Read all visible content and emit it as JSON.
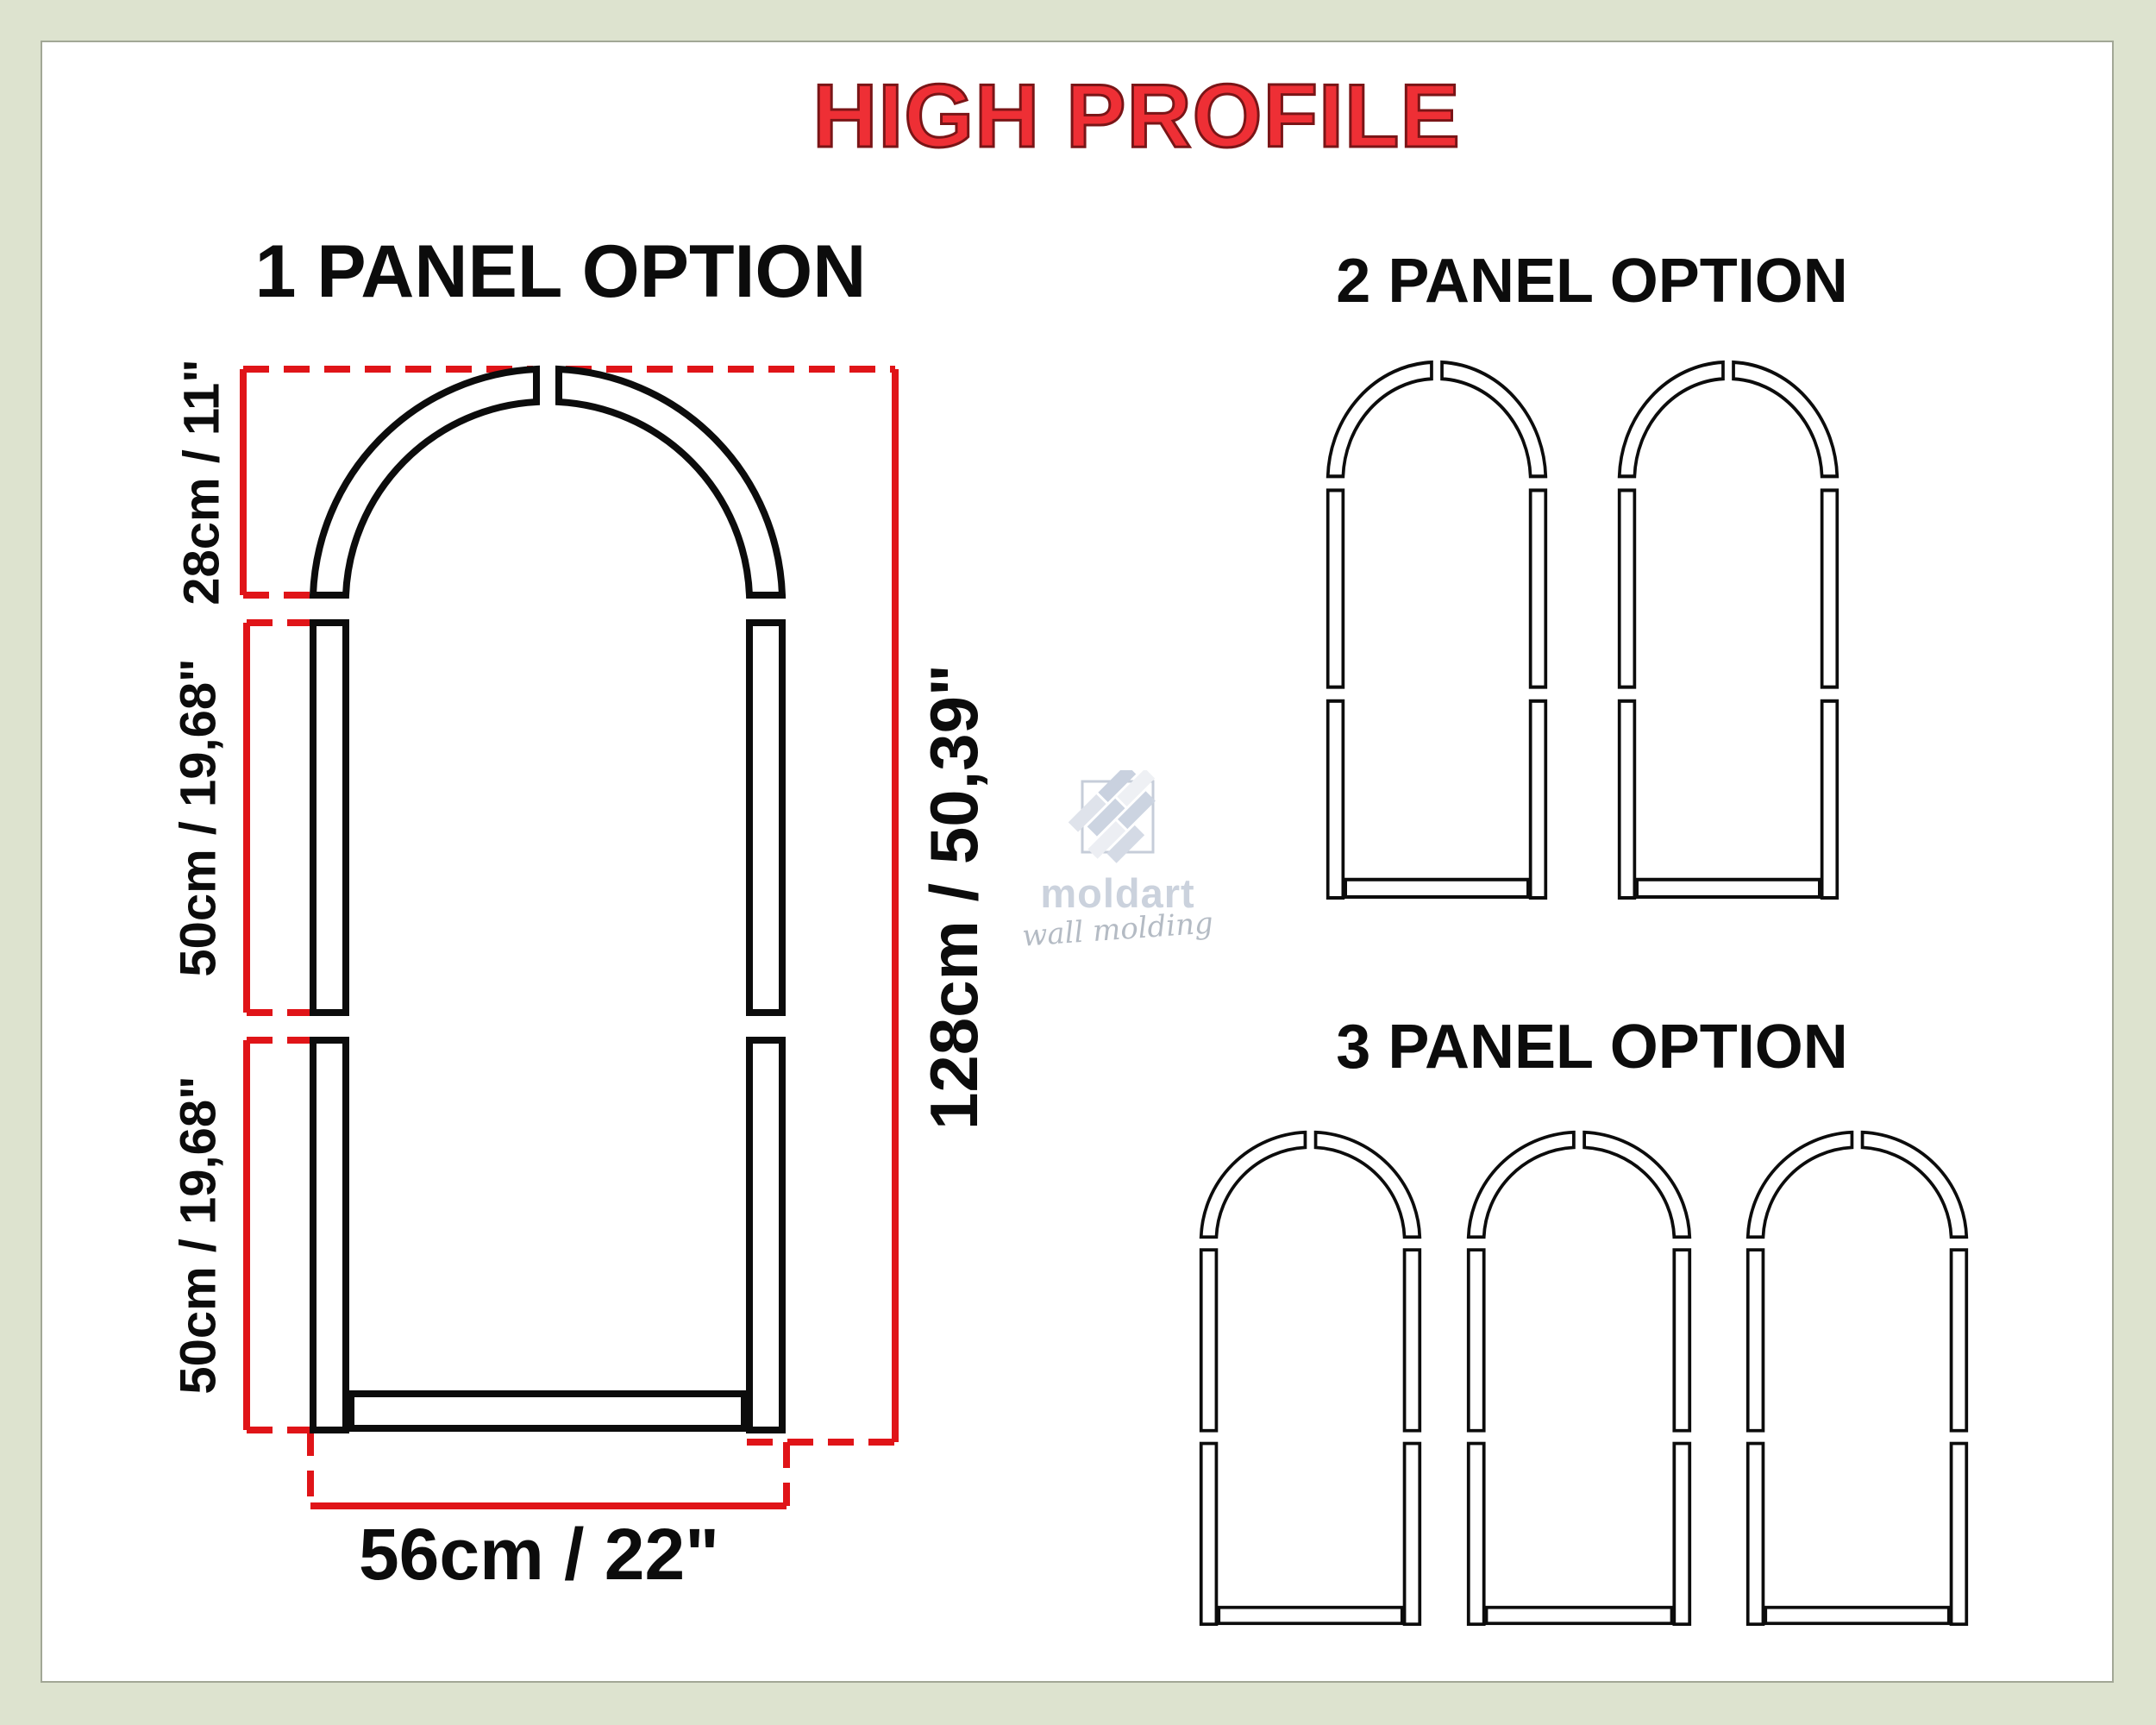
{
  "title": "HIGH PROFILE",
  "sections": {
    "one_panel": {
      "heading": "1 PANEL OPTION",
      "panel_count": 1,
      "dimensions": {
        "arch_height": "28cm / 11\"",
        "upper_side": "50cm / 19,68\"",
        "lower_side": "50cm / 19,68\"",
        "total_height": "128cm / 50,39\"",
        "width": "56cm / 22\""
      }
    },
    "two_panel": {
      "heading": "2 PANEL OPTION",
      "panel_count": 2
    },
    "three_panel": {
      "heading": "3 PANEL OPTION",
      "panel_count": 3
    },
    "panel_pieces": [
      "arch-top-left",
      "arch-top-right",
      "upper-left-rail",
      "upper-right-rail",
      "lower-left-rail",
      "lower-right-rail",
      "bottom-rail"
    ]
  },
  "watermark": {
    "brand": "moldart",
    "tagline": "wall molding"
  },
  "colors": {
    "background": "#dde3cf",
    "panel": "#ffffff",
    "panel_border": "#a2a796",
    "dimension_red": "#e01418",
    "title_fill": "#ee2f35",
    "title_outline": "#7a1517",
    "ink": "#0c0c0c",
    "watermark_gray": "#ccd3de"
  }
}
